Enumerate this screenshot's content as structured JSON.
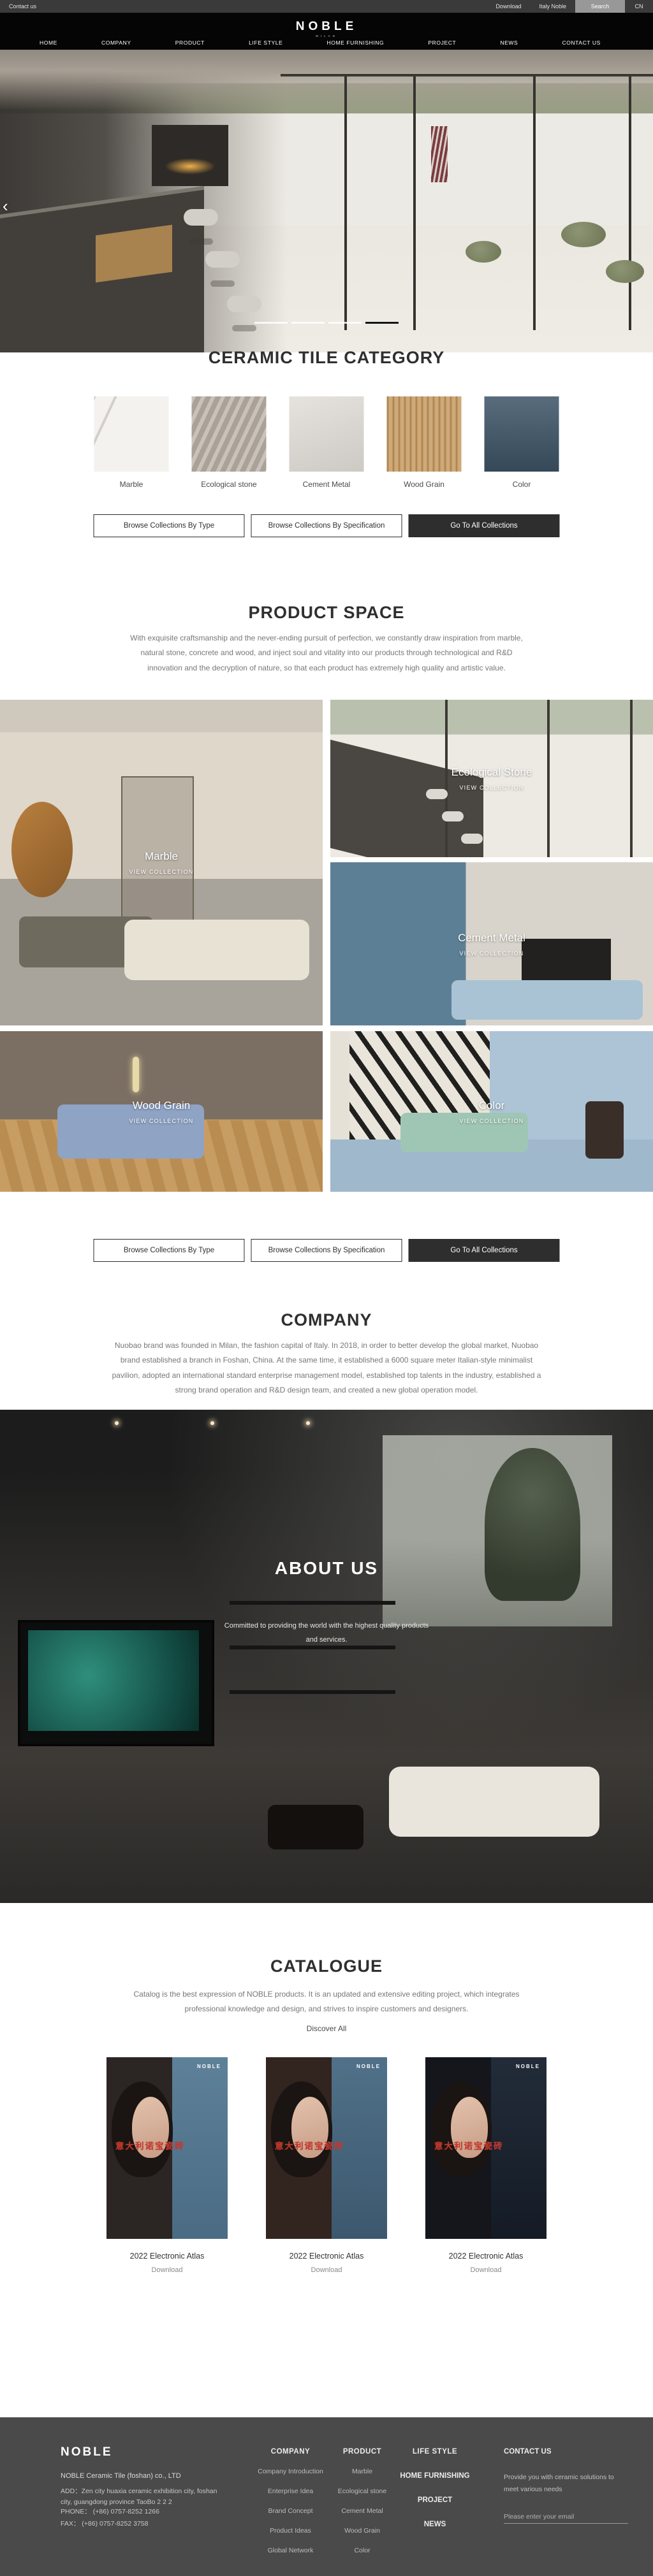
{
  "topbar": {
    "contact": "Contact us",
    "download": "Download",
    "italy": "Italy Noble",
    "search": "Search",
    "lang": "CN"
  },
  "header": {
    "logo": "NOBLE",
    "logo_sub": "MILAN",
    "nav": [
      "HOME",
      "COMPANY",
      "PRODUCT",
      "LIFE STYLE",
      "HOME FURNISHING",
      "PROJECT",
      "NEWS",
      "CONTACT US"
    ]
  },
  "hero": {
    "prev_arrow": "‹",
    "slide_count": 4,
    "active_slide": 4
  },
  "category": {
    "title": "CERAMIC TILE CATEGORY",
    "items": [
      {
        "label": "Marble",
        "color": "#f4f2ef"
      },
      {
        "label": "Ecological stone",
        "color": "#b3aa9f"
      },
      {
        "label": "Cement Metal",
        "color": "#d8d4ce"
      },
      {
        "label": "Wood Grain",
        "color": "#c59a63"
      },
      {
        "label": "Color",
        "color": "#41586b"
      }
    ]
  },
  "collections_buttons": {
    "by_type": "Browse Collections By Type",
    "by_spec": "Browse Collections By Specification",
    "all": "Go To All Collections"
  },
  "product_space": {
    "title": "PRODUCT SPACE",
    "description": "With exquisite craftsmanship and the never-ending pursuit of perfection, we constantly draw inspiration from marble, natural stone, concrete and wood, and inject soul and vitality into our products through technological and R&D innovation and the decryption of nature, so that each product has extremely high quality and artistic value.",
    "tiles": [
      {
        "label": "Marble",
        "cta": "VIEW COLLECTION"
      },
      {
        "label": "Ecological Stone",
        "cta": "VIEW COLLECTION"
      },
      {
        "label": "Cement Metal",
        "cta": "VIEW COLLECTION"
      },
      {
        "label": "Wood Grain",
        "cta": "VIEW COLLECTION"
      },
      {
        "label": "Color",
        "cta": "VIEW COLLECTION"
      }
    ]
  },
  "company": {
    "title": "COMPANY",
    "description": "Nuobao brand was founded in Milan, the fashion capital of Italy. In 2018, in order to better develop the global market, Nuobao brand established a branch in Foshan, China. At the same time, it established a 6000 square meter Italian-style minimalist pavilion, adopted an international standard enterprise management model, established top talents in the industry, established a strong brand operation and R&D design team, and created a new global operation model."
  },
  "about": {
    "title": "ABOUT US",
    "tagline1": "Committed to providing the world with the highest quality products",
    "tagline2": "and services."
  },
  "catalogue": {
    "title": "CATALOGUE",
    "description": "Catalog is the best expression of NOBLE products. It is an updated and extensive editing project, which integrates professional knowledge and design, and strives to inspire customers and designers.",
    "discover": "Discover All",
    "cover_logo": "NOBLE",
    "cover_cn": "意大利诺宝瓷砖",
    "items": [
      {
        "title": "2022 Electronic Atlas",
        "download": "Download"
      },
      {
        "title": "2022 Electronic Atlas",
        "download": "Download"
      },
      {
        "title": "2022 Electronic Atlas",
        "download": "Download"
      }
    ]
  },
  "footer": {
    "logo": "NOBLE",
    "company": "NOBLE Ceramic Tile (foshan) co., LTD",
    "address": "ADD：Zen city huaxia ceramic exhibition city, foshan city, guangdong province TaoBo 2 2 2",
    "phone": "PHONE：  (+86)  0757-8252 1266",
    "fax": "FAX：  (+86)  0757-8252 3758",
    "company_col": {
      "title": "COMPANY",
      "items": [
        "Company Introduction",
        "Enterprise Idea",
        "Brand Concept",
        "Product Ideas",
        "Global Network"
      ]
    },
    "product_col": {
      "title": "PRODUCT",
      "items": [
        "Marble",
        "Ecological stone",
        "Cement Metal",
        "Wood Grain",
        "Color"
      ]
    },
    "nav_col": {
      "life_style": "LIFE STYLE",
      "home_furnishing": "HOME FURNISHING",
      "project": "PROJECT",
      "news": "NEWS"
    },
    "contact": {
      "title": "CONTACT US",
      "text": "Provide you with ceramic solutions to meet various needs",
      "placeholder": "Please enter your email"
    }
  },
  "colors": {
    "accent_red": "#c0392f",
    "footer_bg": "#4a4a4a",
    "dark_button": "#2e2e2e",
    "header_bg": "#050505"
  }
}
